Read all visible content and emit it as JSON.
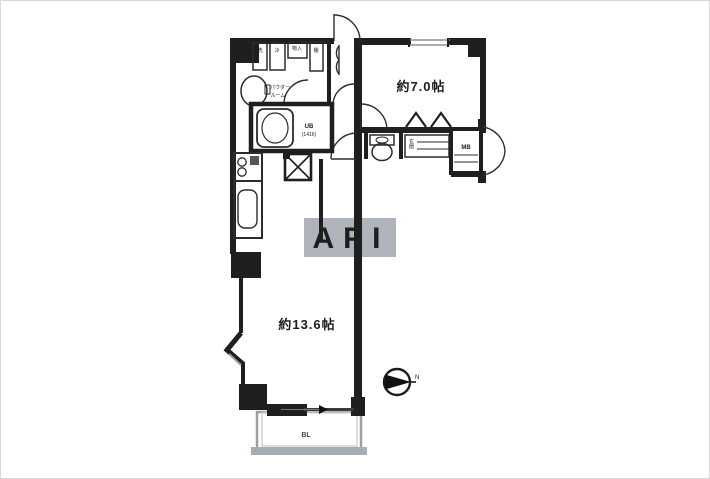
{
  "floorplan": {
    "watermark": "API",
    "rooms": {
      "bedroom": {
        "label": "約7.0帖"
      },
      "living": {
        "label": "約13.6帖"
      },
      "unit_bath": {
        "label_line1": "UB",
        "label_line2": "(1416)"
      },
      "powder_room": {
        "label_line1": "パウダー",
        "label_line2": "ルーム"
      },
      "entrance": {
        "label": "玄関"
      },
      "balcony": {
        "label": "BL"
      },
      "meter_box": {
        "label": "MB"
      }
    },
    "fixtures": {
      "storage_1": "洗",
      "storage_2": "冷",
      "storage_3": "物入",
      "storage_4": "棚"
    },
    "compass": {
      "north_label": "N"
    },
    "colors": {
      "wall": "#1f1f1f",
      "line": "#2f2f2f",
      "balcony_line": "#9aa0a6",
      "balcony_band": "#a7adb3",
      "watermark_bg": "#a8aeb5",
      "watermark_text": "#ffffff",
      "background": "#ffffff"
    }
  }
}
